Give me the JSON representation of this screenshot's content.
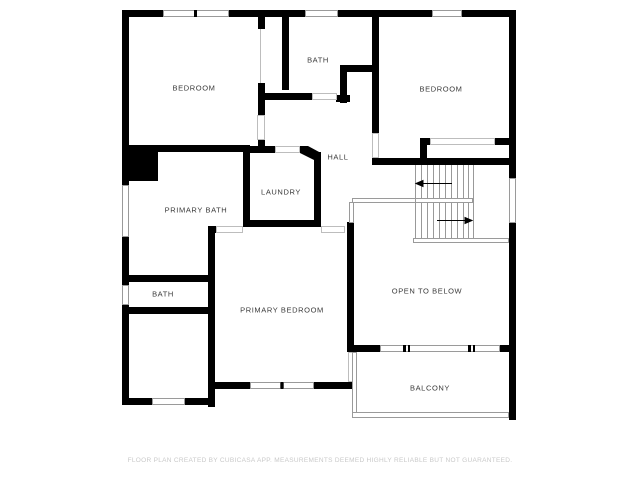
{
  "plan": {
    "title": "Second floor plan",
    "rooms": [
      {
        "id": "bedroom-top-left",
        "label": "BEDROOM"
      },
      {
        "id": "bath-top-middle",
        "label": "BATH"
      },
      {
        "id": "bedroom-top-right",
        "label": "BEDROOM"
      },
      {
        "id": "hall",
        "label": "HALL"
      },
      {
        "id": "laundry",
        "label": "LAUNDRY"
      },
      {
        "id": "primary-bath",
        "label": "PRIMARY BATH"
      },
      {
        "id": "bath-small",
        "label": "BATH"
      },
      {
        "id": "primary-bedroom",
        "label": "PRIMARY BEDROOM"
      },
      {
        "id": "open-to-below",
        "label": "OPEN TO BELOW"
      },
      {
        "id": "balcony",
        "label": "BALCONY"
      }
    ],
    "stairs": {
      "flights": 2,
      "upper_arrow_direction": "left",
      "lower_arrow_direction": "right"
    },
    "colors": {
      "wall": "#000000",
      "window_line": "#9a9a9a",
      "railing_line": "#9a9a9a",
      "stair_tread_line": "#999999",
      "label_text": "#3a3a3a",
      "footer_text": "#c9c9c9",
      "background": "#ffffff"
    }
  },
  "footer": {
    "text": "FLOOR PLAN CREATED BY CUBICASA APP. MEASUREMENTS DEEMED HIGHLY RELIABLE BUT NOT GUARANTEED."
  }
}
